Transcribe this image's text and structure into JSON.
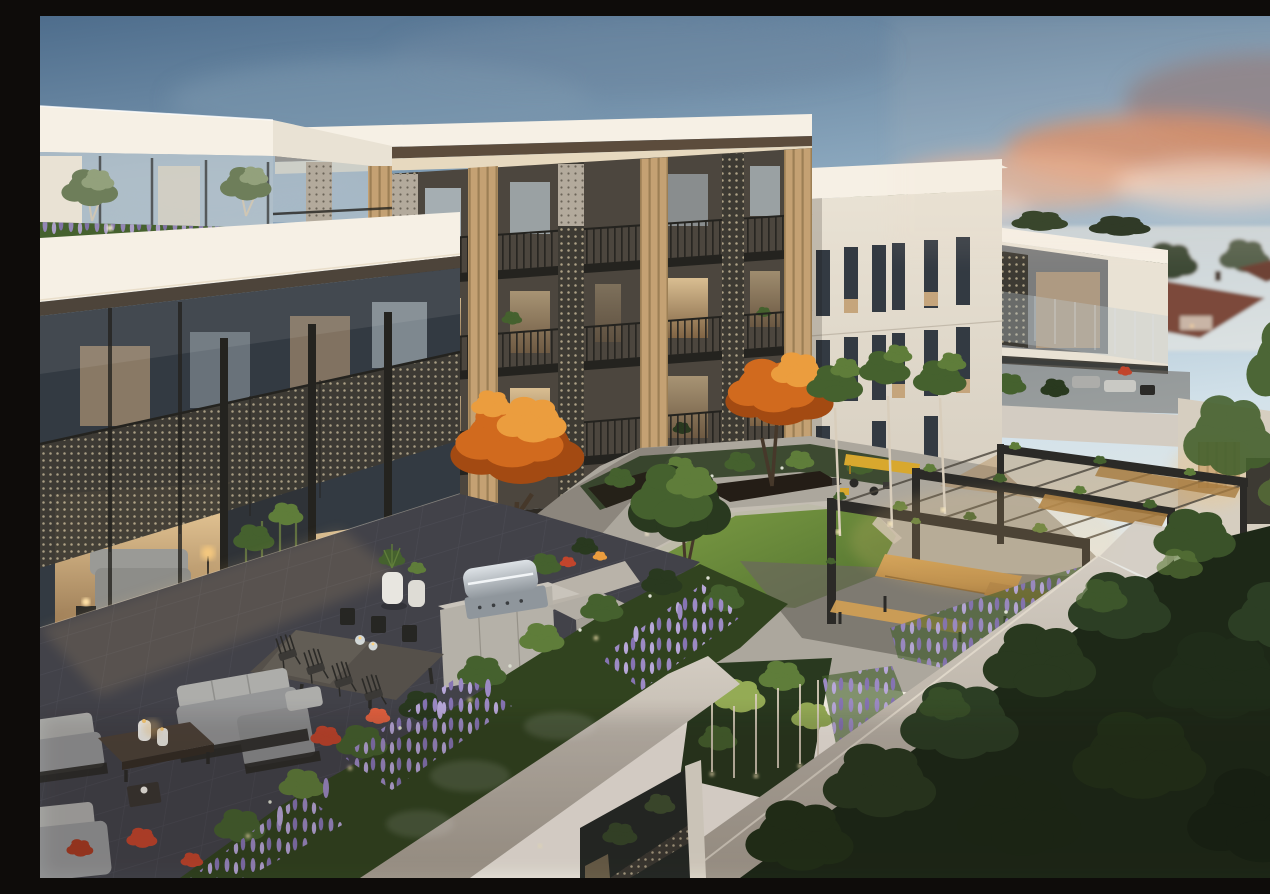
{
  "scene": {
    "type": "architectural-render",
    "description": "Dusk aerial rendering of a modern multi-storey apartment complex: timber and perforated-screen facade, rooftop terrace with outdoor lounge, dining set and BBQ, landscaped central courtyard with lawn, steel pergolas, timber benches, autumn trees, lavender and red flower beds, lit bamboo garden, and suburban rooftops in the distance under a pink sunset cloud.",
    "time_of_day": "dusk",
    "elements": [
      "sky",
      "sunset-clouds",
      "left-tower",
      "center-apartment-block",
      "right-apartment-block",
      "far-right-wing",
      "suburban-rooftops",
      "rooftop-terrace",
      "perforated-screens",
      "timber-slat-panels",
      "balcony-railings",
      "lit-interiors",
      "outdoor-lounge-set",
      "coffee-table",
      "dining-set",
      "bbq-island",
      "planter-pots",
      "bamboo-screen",
      "courtyard-lawn",
      "paved-paths",
      "garden-beds",
      "pergolas",
      "picnic-tables",
      "yellow-bench",
      "cafe-tables",
      "autumn-trees",
      "green-trees",
      "lavender-beds",
      "red-flowers",
      "uplit-bamboo-garden",
      "garden-walls",
      "tree-canopy-mass",
      "path-lights"
    ]
  },
  "palette": {
    "sky_top": "#4e6d8c",
    "sky_mid": "#93afc4",
    "sky_low": "#d3e2ea",
    "sky_warm": "#f1ebe1",
    "cloud_grey": "#8a7c80",
    "cloud_orange": "#dd8a5c",
    "cloud_pink": "#eaaf8e",
    "cloud_cream": "#f3d9c6",
    "facade_bright": "#f6f0e5",
    "facade_light": "#e9e2d4",
    "facade_shade": "#d6cec0",
    "facade_dark": "#b5ac9e",
    "soffit_cream": "#e7d9bf",
    "capping_brown": "#5c4c3c",
    "timber": "#c4a173",
    "timber_lit": "#e6c48e",
    "glass_cool": "#bcc8cf",
    "glass_dark": "#333a42",
    "glass_warm": "#dfb887",
    "interior_glow": "#f2d3a0",
    "screen_light": "#b3aa9c",
    "screen_dark": "#3d3a33",
    "rail_dark": "#24231f",
    "lawn_light": "#7d9c44",
    "lawn_dark": "#50712f",
    "leaf_dark": "#29391f",
    "leaf_mid": "#45612e",
    "leaf_light": "#5f7d3a",
    "leaf_bright": "#94ab55",
    "autumn_dark": "#a34a12",
    "autumn_mid": "#d16a1e",
    "autumn_light": "#eb9d3e",
    "lavender": "#9c8ac4",
    "lavender_light": "#b7a7d8",
    "flower_red": "#c2452c",
    "flower_white": "#dde0d2",
    "paving": "#aca79d",
    "paving_dark": "#6b665e",
    "stone_edge": "#c6c0b5",
    "tile_dark": "#424249",
    "tile_line": "#585863",
    "concrete_wall": "#d3ccc2",
    "sofa_grey": "#959697",
    "sofa_light": "#adadaa",
    "frame_dark": "#2b2a27",
    "wood_table": "#4f463d",
    "bench_timber": "#cf9e54",
    "bench_timber_dark": "#a87c40",
    "accent_yellow": "#d8a82e",
    "steel_light": "#dde2e6",
    "steel_dark": "#8f969c",
    "trunk_dark": "#46382a",
    "trunk_light": "#d8cdbb",
    "roof_red": "#7c4a3a",
    "roof_grey": "#958a7f",
    "suburb_green": "#3d4a35",
    "planter_dark": "#241d16",
    "glow_warm": "#f5c87e",
    "night_shadow": "#17110b"
  }
}
